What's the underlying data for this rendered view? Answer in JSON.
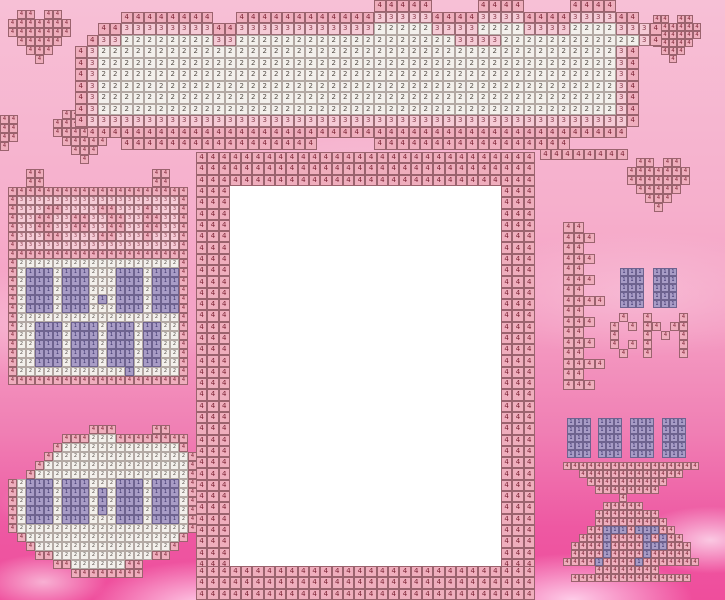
{
  "title": "Cross-stitch photo-frame pattern with clouds and hearts",
  "legend": {
    "symbols": [
      "1",
      "2",
      "3",
      "4"
    ],
    "colors": {
      "1": "#a89cc6",
      "2": "#f3f0ec",
      "3": "#f5cbd6",
      "4": "#efaebd"
    },
    "number_colors": {
      "1": "#39306a",
      "2": "#554e48",
      "3": "#8c4050",
      "4": "#7c2334"
    },
    "background_top": "#f7c0d6",
    "background_bottom": "#ef4d9c",
    "photo_area_color": "#ffffff"
  },
  "photo_area": {
    "x": 230,
    "y": 186,
    "w": 272,
    "h": 380
  },
  "pattern": {
    "shapes": [
      {
        "name": "heart-top-left",
        "x": 8,
        "y": 10,
        "cell": 9,
        "rows": [
          ".44.44.",
          "4444444",
          "4444444",
          ".44444.",
          "..444..",
          "...4..."
        ]
      },
      {
        "name": "heart-left-lower",
        "x": 53,
        "y": 110,
        "cell": 9,
        "rows": [
          ".44.44.",
          "4444444",
          "4444444",
          ".44444.",
          "..444..",
          "...4..."
        ]
      },
      {
        "name": "heart-edge-left",
        "x": 0,
        "y": 115,
        "cell": 9,
        "rows": [
          "44",
          "44",
          "44",
          "4."
        ]
      },
      {
        "name": "heart-top-right",
        "x": 645,
        "y": 15,
        "cell": 8,
        "rows": [
          ".44.44.",
          "4444444",
          "4444444",
          ".44444.",
          "..444..",
          "...4..."
        ]
      },
      {
        "name": "heart-mid-right",
        "x": 627,
        "y": 158,
        "cell": 9,
        "rows": [
          ".44.44.",
          "4444444",
          "4444444",
          ".44444.",
          "..444..",
          "...4..."
        ]
      },
      {
        "name": "big-cloud-top",
        "x": 75,
        "y": 0,
        "cell": 11.5,
        "rows": [
          "..........................44444....4444....4444....",
          "....44444444..44444444444433333444433334444333344..",
          "..4433333333443333333333332222233332222333322223334.",
          ".43322222222332222222222222222222333322222222222234",
          "4322222222222222222222222222222222222222222222234",
          "4322222222222222222222222222222222222222222222234",
          "4322222222222222222222222222222222222222222222234",
          "4322222222222222222222222222222222222222222222234",
          "4322222222222222222222222222222222222222222222234",
          "4322222222222222222222222222222222222222222222234",
          "4333333333333333333333333333333333333333333333334",
          ".44444444444444444444444444444444444444444444444.",
          "....44444444444444444.....44444444444444444........"
        ]
      },
      {
        "name": "cloud-bottom-right-edge",
        "x": 540,
        "y": 149,
        "cell": 11,
        "rows": [
          "44444444"
        ]
      },
      {
        "name": "stitch-panel-left",
        "x": 8,
        "y": 169,
        "cell": 9,
        "rows": [
          "..44............44..",
          "..44............44..",
          "44444444444444444444",
          "43333333333333333334",
          "43334433334433343334",
          "43344334433443344334",
          "43344334433443344334",
          "43334433334433343334",
          "43333333333333333334",
          "44444444444444444444",
          "42222222222222222224",
          "42111211122211121114",
          "42111211122211121114",
          "42111211122211121114",
          "42111211121211121114",
          "42111211122211121114",
          "42222222222222222224",
          "42211121112111211224",
          "42211121112111211224",
          "42211121112111211224",
          "42211121112111211224",
          "42211121112111211224",
          "42222222222221222224",
          "44444444444444444444"
        ]
      },
      {
        "name": "round-cloud-bottom-left",
        "x": 8,
        "y": 425,
        "cell": 9,
        "rows": [
          ".........444....44...",
          "......44422244444444.",
          ".....422222222222224.",
          "....42222222222222224",
          "...422222222222222224",
          "..4222222222222222224",
          "421112111222111211124",
          "421112111212111211124",
          "421112111212111211124",
          "421112111212111211124",
          "421112111222111211124",
          "422222222222222222224",
          ".4222222222222222224.",
          "..42222222222222224..",
          "...442222222222244...",
          ".....4422222244......",
          ".......44444444......"
        ]
      },
      {
        "name": "frame-border-top",
        "x": 196,
        "y": 152,
        "cell": 11.3,
        "rows": [
          "444444444444444444444444444444",
          "444444444444444444444444444444",
          "444444444444444444444444444444"
        ]
      },
      {
        "name": "frame-border-left",
        "x": 196,
        "y": 186,
        "cell": 11.3,
        "rows": [
          "444",
          "444",
          "444",
          "444",
          "444",
          "444",
          "444",
          "444",
          "444",
          "444",
          "444",
          "444",
          "444",
          "444",
          "444",
          "444",
          "444",
          "444",
          "444",
          "444",
          "444",
          "444",
          "444",
          "444",
          "444",
          "444",
          "444",
          "444",
          "444",
          "444",
          "444",
          "444",
          "444",
          "444"
        ]
      },
      {
        "name": "frame-border-right",
        "x": 501,
        "y": 186,
        "cell": 11.3,
        "rows": [
          "444",
          "444",
          "444",
          "444",
          "444",
          "444",
          "444",
          "444",
          "444",
          "444",
          "444",
          "444",
          "444",
          "444",
          "444",
          "444",
          "444",
          "444",
          "444",
          "444",
          "444",
          "444",
          "444",
          "444",
          "444",
          "444",
          "444",
          "444",
          "444",
          "444",
          "444",
          "444",
          "444",
          "444"
        ]
      },
      {
        "name": "frame-border-bottom",
        "x": 196,
        "y": 566,
        "cell": 11.3,
        "rows": [
          "444444444444444444444444444444",
          "444444444444444444444444444444",
          "444444444444444444444444444444"
        ]
      },
      {
        "name": "garland-strip-right",
        "x": 563,
        "y": 222,
        "cell": 10.5,
        "rows": [
          "44..",
          "444.",
          "44..",
          "444.",
          "44..",
          "444.",
          "44..",
          "4444",
          "44..",
          "444.",
          "44..",
          "444.",
          "44..",
          "4444",
          "44..",
          "444."
        ]
      },
      {
        "name": "purple-block-upper-1",
        "x": 620,
        "y": 268,
        "cell": 8,
        "rows": [
          "111",
          "111",
          "111",
          "111",
          "111"
        ]
      },
      {
        "name": "purple-block-upper-2",
        "x": 653,
        "y": 268,
        "cell": 8,
        "rows": [
          "111",
          "111",
          "111",
          "111",
          "111"
        ]
      },
      {
        "name": "letter-c-motif",
        "x": 610,
        "y": 313,
        "cell": 9,
        "rows": [
          ".4.",
          "4.4",
          "4..",
          "4.4",
          ".4."
        ]
      },
      {
        "name": "letter-m-motif",
        "x": 643,
        "y": 313,
        "cell": 9,
        "rows": [
          "4...4",
          "44.44",
          "4.4.4",
          "4...4",
          "4...4"
        ]
      },
      {
        "name": "purple-block-row-1",
        "x": 567,
        "y": 418,
        "cell": 8,
        "rows": [
          "111",
          "111",
          "111",
          "111",
          "111"
        ]
      },
      {
        "name": "purple-block-row-2",
        "x": 598,
        "y": 418,
        "cell": 8,
        "rows": [
          "111",
          "111",
          "111",
          "111",
          "111"
        ]
      },
      {
        "name": "purple-block-row-3",
        "x": 630,
        "y": 418,
        "cell": 8,
        "rows": [
          "111",
          "111",
          "111",
          "111",
          "111"
        ]
      },
      {
        "name": "purple-block-row-4",
        "x": 662,
        "y": 418,
        "cell": 8,
        "rows": [
          "111",
          "111",
          "111",
          "111",
          "111"
        ]
      },
      {
        "name": "cake-stand-motif",
        "x": 563,
        "y": 462,
        "cell": 8,
        "rows": [
          "44444444444444444",
          "..4444444444444..",
          "...4444444444....",
          "....44444444.....",
          ".......4.........",
          ".....44444.......",
          "....44444444.....",
          "....444444444....",
          "...44111411144...",
          "..4441444414144..",
          ".444414444111444.",
          ".444414444144444.",
          "44441444414444444",
          "....44444444.....",
          ".444444444444444."
        ]
      }
    ]
  }
}
